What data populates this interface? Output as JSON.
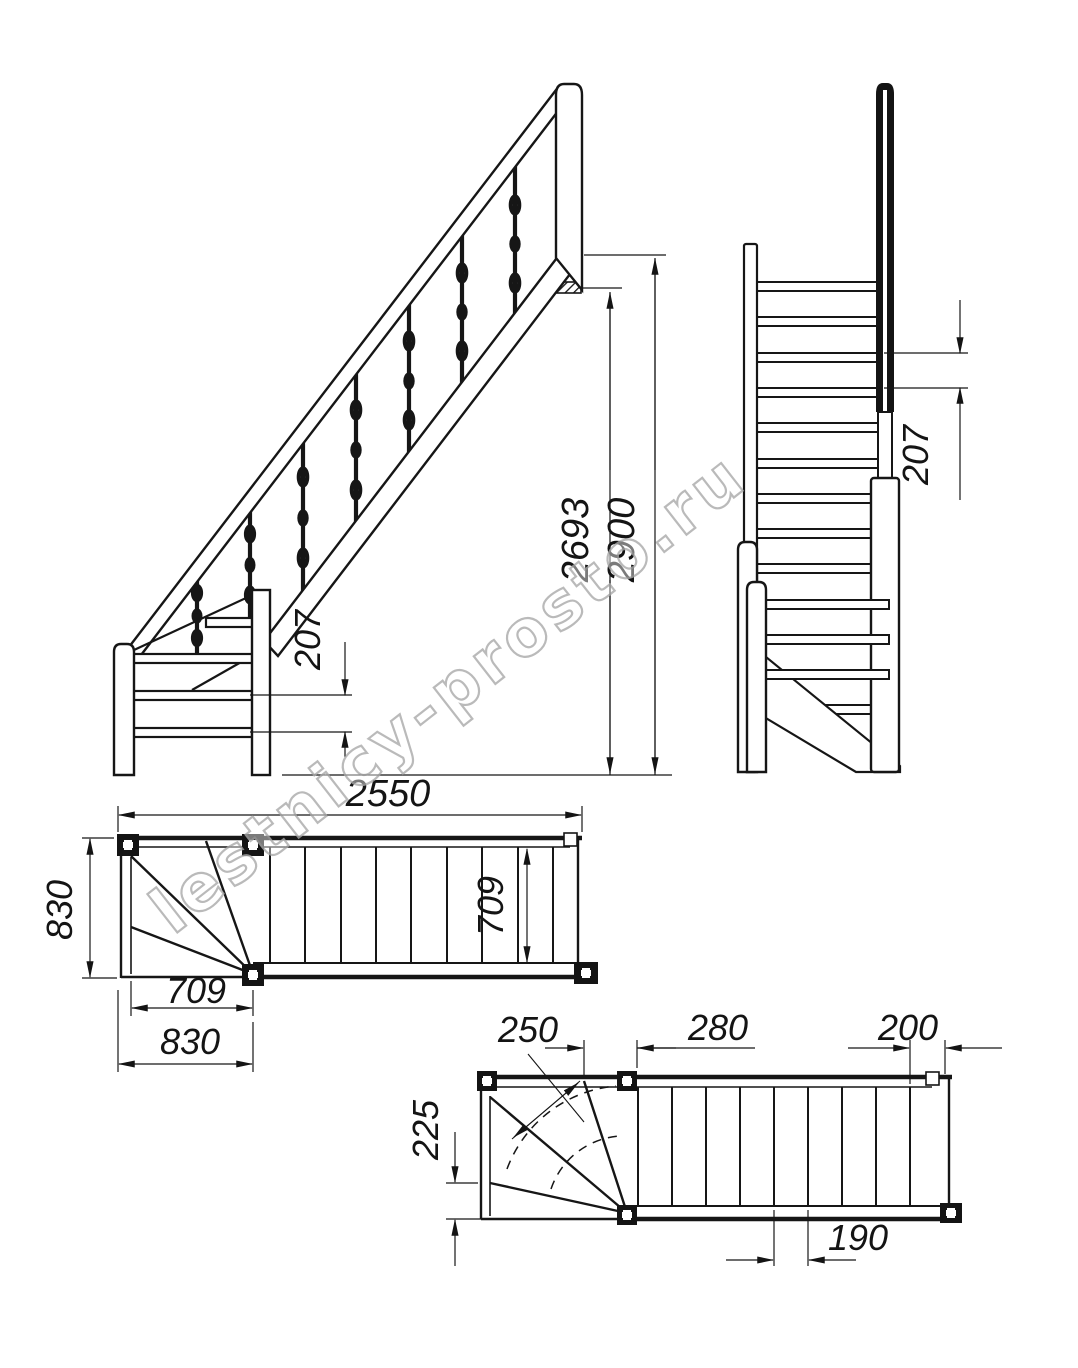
{
  "page": {
    "background": "#ffffff",
    "line_color": "#161616"
  },
  "watermark": {
    "text": "lestnicy-prosto.ru",
    "color": "#a9a9a9"
  },
  "views": {
    "side_elevation": {
      "label": "side-elevation",
      "dimensions": {
        "total_height": "2900",
        "floor_height": "2693",
        "riser_height": "207"
      }
    },
    "front_elevation": {
      "label": "front-elevation",
      "dimensions": {
        "riser_height": "207"
      }
    },
    "top_plan": {
      "label": "upper-plan",
      "dimensions": {
        "total_length": "2550",
        "stair_width": "830",
        "flight_width": "709",
        "winder_width": "709",
        "winder_length": "830"
      }
    },
    "bottom_plan": {
      "label": "lower-plan",
      "dimensions": {
        "walkline_tread_depth": "250",
        "first_tread": "280",
        "last_tread": "200",
        "winder_narrow_depth": "225",
        "tread_depth": "190"
      }
    }
  }
}
